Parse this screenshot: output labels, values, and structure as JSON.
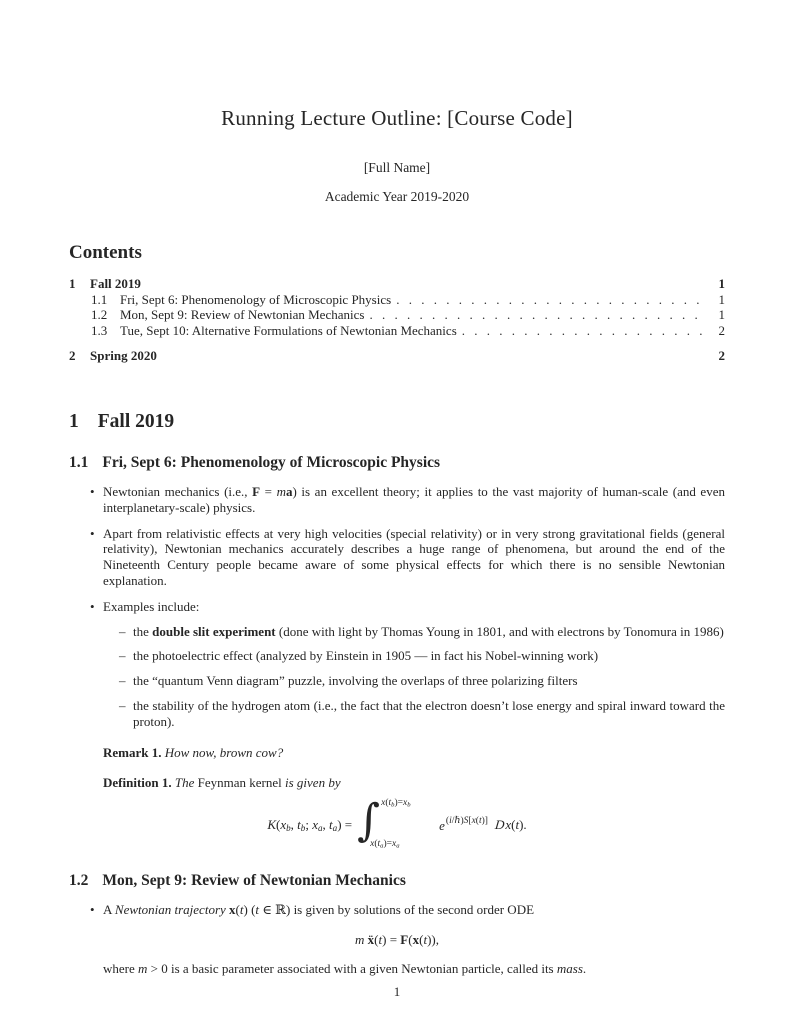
{
  "header": {
    "title": "Running Lecture Outline: [Course Code]",
    "author": "[Full Name]",
    "date": "Academic Year 2019-2020"
  },
  "contents": {
    "heading": "Contents",
    "entries": [
      {
        "level": 1,
        "number": "1",
        "label": "Fall 2019",
        "page": "1"
      },
      {
        "level": 2,
        "number": "1.1",
        "label": "Fri, Sept 6: Phenomenology of Microscopic Physics",
        "page": "1"
      },
      {
        "level": 2,
        "number": "1.2",
        "label": "Mon, Sept 9: Review of Newtonian Mechanics",
        "page": "1"
      },
      {
        "level": 2,
        "number": "1.3",
        "label": "Tue, Sept 10: Alternative Formulations of Newtonian Mechanics",
        "page": "2"
      },
      {
        "level": 1,
        "number": "2",
        "label": "Spring 2020",
        "page": "2"
      }
    ]
  },
  "glyphs": {
    "bullet": "•",
    "dash": "–",
    "integral_sign": "∫"
  },
  "section1": {
    "number": "1",
    "title": "Fall 2019"
  },
  "s11": {
    "number": "1.1",
    "title": "Fri, Sept 6: Phenomenology of Microscopic Physics",
    "b1": [
      {
        "t": "Newtonian mechanics (i.e., "
      },
      {
        "t": "F",
        "b": 1
      },
      {
        "t": " = "
      },
      {
        "t": "m",
        "i": 1
      },
      {
        "t": "a",
        "b": 1
      },
      {
        "t": ") is an excellent theory; it applies to the vast majority of human-scale (and even interplanetary-scale) physics."
      }
    ],
    "b2": [
      {
        "t": "Apart from relativistic effects at very high velocities (special relativity) or in very strong gravitational fields (general relativity), Newtonian mechanics accurately describes a huge range of phenomena, but around the end of the Nineteenth Century people became aware of some physical effects for which there is no sensible Newtonian explanation."
      }
    ],
    "b3": [
      {
        "t": "Examples include:"
      }
    ],
    "sub1": [
      {
        "t": "the "
      },
      {
        "t": "double slit experiment",
        "b": 1
      },
      {
        "t": " (done with light by Thomas Young in 1801, and with electrons by Tonomura in 1986)"
      }
    ],
    "sub2": [
      {
        "t": "the photoelectric effect (analyzed by Einstein in 1905 — in fact his Nobel-winning work)"
      }
    ],
    "sub3": [
      {
        "t": "the “quantum Venn diagram” puzzle, involving the overlaps of three polarizing filters"
      }
    ],
    "sub4": [
      {
        "t": "the stability of the hydrogen atom (i.e., the fact that the electron doesn’t lose energy and spiral inward toward the proton)."
      }
    ],
    "remark": [
      {
        "t": "Remark 1.",
        "b": 1
      },
      {
        "t": "  "
      },
      {
        "t": "How now, brown cow?",
        "i": 1
      }
    ],
    "definition": [
      {
        "t": "Definition 1.",
        "b": 1
      },
      {
        "t": "  "
      },
      {
        "t": "The ",
        "i": 1
      },
      {
        "t": "Feynman kernel"
      },
      {
        "t": " is given by",
        "i": 1
      }
    ],
    "formula": {
      "lhs": [
        {
          "t": "K",
          "i": 1
        },
        {
          "t": "("
        },
        {
          "t": "x",
          "i": 1
        },
        {
          "t": "b",
          "i": 1,
          "sub": 1
        },
        {
          "t": ", "
        },
        {
          "t": "t",
          "i": 1
        },
        {
          "t": "b",
          "i": 1,
          "sub": 1
        },
        {
          "t": "; "
        },
        {
          "t": "x",
          "i": 1
        },
        {
          "t": "a",
          "i": 1,
          "sub": 1
        },
        {
          "t": ", "
        },
        {
          "t": "t",
          "i": 1
        },
        {
          "t": "a",
          "i": 1,
          "sub": 1
        },
        {
          "t": ") = "
        }
      ],
      "upper_limit": [
        {
          "t": "x",
          "i": 1
        },
        {
          "t": "("
        },
        {
          "t": "t",
          "i": 1
        },
        {
          "t": "b",
          "i": 1,
          "sub": 1
        },
        {
          "t": ")="
        },
        {
          "t": "x",
          "i": 1
        },
        {
          "t": "b",
          "i": 1,
          "sub": 1
        }
      ],
      "lower_limit": [
        {
          "t": "x",
          "i": 1
        },
        {
          "t": "("
        },
        {
          "t": "t",
          "i": 1
        },
        {
          "t": "a",
          "i": 1,
          "sub": 1
        },
        {
          "t": ")="
        },
        {
          "t": "x",
          "i": 1
        },
        {
          "t": "a",
          "i": 1,
          "sub": 1
        }
      ],
      "integrand_base": "e",
      "exponent": [
        {
          "t": "("
        },
        {
          "t": "i",
          "i": 1
        },
        {
          "t": "/"
        },
        {
          "t": "ℏ",
          "sym": 1
        },
        {
          "t": ")"
        },
        {
          "t": "S",
          "i": 1
        },
        {
          "t": "["
        },
        {
          "t": "x",
          "i": 1
        },
        {
          "t": "("
        },
        {
          "t": "t",
          "i": 1
        },
        {
          "t": ")]"
        }
      ],
      "measure": [
        {
          "t": "D",
          "scr": 1
        },
        {
          "t": "x",
          "i": 1
        },
        {
          "t": "("
        },
        {
          "t": "t",
          "i": 1
        },
        {
          "t": ")."
        }
      ]
    }
  },
  "s12": {
    "number": "1.2",
    "title": "Mon, Sept 9: Review of Newtonian Mechanics",
    "b1": [
      {
        "t": "A "
      },
      {
        "t": "Newtonian trajectory",
        "i": 1
      },
      {
        "t": " "
      },
      {
        "t": "x",
        "b": 1
      },
      {
        "t": "("
      },
      {
        "t": "t",
        "i": 1
      },
      {
        "t": ") ("
      },
      {
        "t": "t",
        "i": 1
      },
      {
        "t": " "
      },
      {
        "t": "∈",
        "sym": 1
      },
      {
        "t": " "
      },
      {
        "t": "ℝ",
        "sym": 1
      },
      {
        "t": ") is given by solutions of the second order ODE"
      }
    ],
    "equation": [
      {
        "t": "m",
        "i": 1
      },
      {
        "t": " "
      },
      {
        "t": "ẍ",
        "b": 1
      },
      {
        "t": "("
      },
      {
        "t": "t",
        "i": 1
      },
      {
        "t": ") = "
      },
      {
        "t": "F",
        "b": 1
      },
      {
        "t": "("
      },
      {
        "t": "x",
        "b": 1
      },
      {
        "t": "("
      },
      {
        "t": "t",
        "i": 1
      },
      {
        "t": ")),"
      }
    ],
    "where": [
      {
        "t": "where "
      },
      {
        "t": "m",
        "i": 1
      },
      {
        "t": " > 0 is a basic parameter associated with a given Newtonian particle, called its "
      },
      {
        "t": "mass",
        "i": 1
      },
      {
        "t": "."
      }
    ]
  },
  "footer": {
    "page_number": "1"
  }
}
